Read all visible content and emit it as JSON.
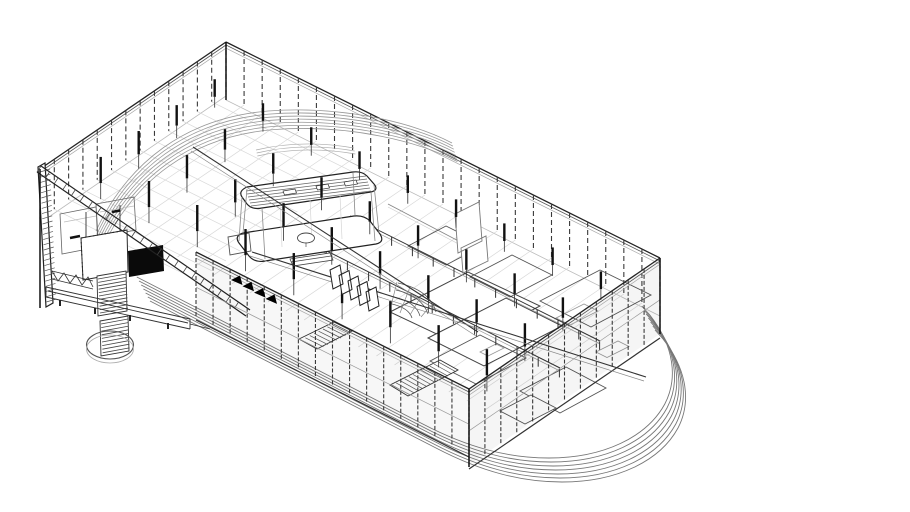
{
  "meta": {
    "title": "Axonometric wireframe cutaway drawing of a rectangular building with a surrounding curved track"
  },
  "palette": {
    "background": "#ffffff",
    "ink": "#111111",
    "dark": "#222222",
    "mid": "#555555",
    "light": "#999999",
    "faint": "#d8d8d8",
    "solid_fill": "#000000"
  },
  "drawing": {
    "corners": {
      "top": [
        226,
        42
      ],
      "right": [
        660,
        258
      ],
      "bottom": [
        469,
        389
      ],
      "left": [
        40,
        169
      ]
    },
    "walls": [
      {
        "a": [
          226,
          42
        ],
        "b": [
          660,
          258
        ],
        "n": 24,
        "drop": 54,
        "dash": "5 3",
        "beam": {
          "dir": [
            -0.826,
            0.563
          ],
          "len": 190
        },
        "front": false
      },
      {
        "a": [
          226,
          42
        ],
        "b": [
          40,
          169
        ],
        "n": 13,
        "drop": 50,
        "dash": "5 3",
        "beam": {
          "dir": [
            0.894,
            0.445
          ],
          "len": 160
        },
        "front": false
      },
      {
        "a": [
          196,
          252
        ],
        "b": [
          469,
          389
        ],
        "n": 16,
        "drop": 64,
        "dash": "4 2",
        "base": true,
        "front": true,
        "tint": "rgba(0,0,0,0.03)"
      },
      {
        "a": [
          469,
          389
        ],
        "b": [
          660,
          258
        ],
        "n": 12,
        "drop": 76,
        "dash": "4 2",
        "base": true,
        "front": true,
        "tint": "rgba(0,0,0,0.04)"
      }
    ],
    "columns": {
      "origin": [
        226,
        42
      ],
      "u": [
        0.894,
        0.445
      ],
      "v": [
        -0.826,
        0.563
      ],
      "a": [
        28,
        82,
        136,
        190,
        244,
        298,
        352,
        406,
        460
      ],
      "b": [
        44,
        90,
        136,
        182
      ],
      "w": 2.4,
      "barFrac": 0.62,
      "color": "#111111"
    },
    "paths": [
      {
        "d": "M150,301 L436,448 C482,472 522,482 562,482 C617,482 660,461 678,428 C691,403 688,371 663,339 L655,330",
        "s": "#777777",
        "w": 0.9,
        "n": 7,
        "dx": -2.2,
        "dy": -4.0
      },
      {
        "d": "M96,231 C128,162 186,118 268,111 C346,105 416,124 452,143",
        "s": "#999999",
        "w": 0.8,
        "n": 7,
        "dx": 0.9,
        "dy": 3.1
      },
      {
        "d": "M256,150 Q302,139 354,148",
        "s": "#aaaaaa",
        "w": 0.7,
        "n": 3,
        "dx": 0.7,
        "dy": 3
      },
      {
        "d": "M388,204 L470,247",
        "s": "#888888",
        "w": 0.9
      },
      {
        "d": "M388,207 L470,250",
        "s": "#cccccc",
        "w": 0.7
      },
      {
        "d": "M390,312 L468,272 L540,306 L462,346 Z",
        "s": "#444444",
        "w": 1,
        "f": "#ffffff"
      },
      {
        "d": "M428,338 L506,298 L562,326 L484,366 Z",
        "s": "#444444",
        "w": 1,
        "f": "#ffffff"
      },
      {
        "d": "M408,246 L446,226 L484,245 L446,265 Z",
        "s": "#555555",
        "w": 0.9
      },
      {
        "d": "M470,277 L512,255 L552,275 L510,297 Z",
        "s": "#555555",
        "w": 0.9
      },
      {
        "d": "M540,301 L600,270 L651,295 L591,327 Z",
        "s": "#555555",
        "w": 0.9
      },
      {
        "d": "M430,361 L480,335 L526,358 L476,384 Z",
        "s": "#555555",
        "w": 0.9
      },
      {
        "d": "M520,391 L566,367 L606,388 L560,413 Z",
        "s": "#555555",
        "w": 0.9
      },
      {
        "d": "M500,411 L531,395 L556,408 L525,424 Z",
        "s": "#555555",
        "w": 0.9,
        "f": "#ffffff"
      },
      {
        "d": "M556,318 l28,-14 l14,7 l-28,14 Z M596,352 l22,-11 l11,5.5 l-22,11 Z M480,352 l16,-8 l8,4 l-16,8 Z",
        "s": "#999999",
        "w": 0.8
      },
      {
        "d": "M305,240 L560,368",
        "s": "#333333",
        "w": 1
      },
      {
        "d": "M305,243 L560,371",
        "s": "#999999",
        "w": 0.7
      },
      {
        "d": "M305,240 l0,9",
        "s": "#333333",
        "w": 1,
        "n": 13,
        "dx": 21.2,
        "dy": 10.7
      },
      {
        "d": "M350,216 L600,341",
        "s": "#333333",
        "w": 1
      },
      {
        "d": "M350,219 L600,344",
        "s": "#999999",
        "w": 0.7
      },
      {
        "d": "M350,216 l0,9",
        "s": "#333333",
        "w": 1,
        "n": 13,
        "dx": 20.8,
        "dy": 10.4
      },
      {
        "d": "M299,339 L334,322 L352,331 L317,349 Z",
        "s": "#333333",
        "w": 0.9,
        "f": "#ffffff"
      },
      {
        "d": "M301,340 L319,349",
        "s": "#555555",
        "w": 0.7,
        "n": 8,
        "dx": 4.4,
        "dy": -2.2
      },
      {
        "d": "M390,385 L440,360 L458,370 L408,396 Z",
        "s": "#333333",
        "w": 0.9,
        "f": "#ffffff"
      },
      {
        "d": "M392,385 L410,395",
        "s": "#555555",
        "w": 0.7,
        "n": 12,
        "dx": 4.2,
        "dy": -2.1
      },
      {
        "d": "M398,283 Q430,290 436,312 M396,290 Q422,296 428,314 M394,297 Q416,302 420,316 M392,304 Q409,308 412,318",
        "s": "#555555",
        "w": 0.8
      },
      {
        "d": "M390,310 L397,282 M400,313 L410,287 M410,315 L423,293 M421,317 L433,303",
        "s": "#888888",
        "w": 0.7
      },
      {
        "d": "M243,233 L354,216 Q364,215 370,221 L380,234 Q385,242 376,244 L265,261 Q255,263 249,256 L239,243 Q234,236 243,233 Z",
        "s": "#222222",
        "w": 1.2,
        "f": "#ffffff"
      },
      {
        "d": "M247,187 L353,172 Q362,171 367,176 L374,184 Q379,190 371,192 L262,208 Q252,210 247,204 L242,197 Q238,191 247,187 Z",
        "s": "#222222",
        "w": 1.2,
        "f": "#ffffff"
      },
      {
        "d": "M246,191 L366,176",
        "s": "#666666",
        "w": 0.7,
        "n": 6,
        "dx": 1.0,
        "dy": 3.0
      },
      {
        "d": "M283,191 l12,-2 l1.5,4 l-12,2 Z M316,186 l12,-2 l1.5,4 l-12,2 Z M344,182 l12,-2 l1.5,4 l-12,2 Z",
        "s": "#333333",
        "w": 0.7,
        "f": "#ffffff"
      },
      {
        "d": "M247,189 L243,233 M242,197 L239,241 M371,192 L375,241 M374,185 L379,233 M262,208 L265,259 M353,173 L355,215",
        "s": "#888888",
        "w": 0.8
      },
      {
        "d": "M280,204 L282,247 M310,199 L312,243 M340,195 L342,239",
        "s": "#d5d5d5",
        "w": 0.7
      },
      {
        "d": "M297.5,238 a8.5,5 0 1 0 17,0 a8.5,5 0 1 0 -17,0",
        "s": "#444444",
        "w": 0.9,
        "f": "#ffffff"
      },
      {
        "d": "M306,243 L306,247",
        "s": "#666666",
        "w": 0.8
      },
      {
        "d": "M290,259 L330,253 L333,260 L293,266 Z M291,262 L331,256",
        "s": "#444444",
        "w": 0.8,
        "f": "#ffffff"
      },
      {
        "d": "M228,237 L249,233 L251,251 L230,255 Z",
        "s": "#555555",
        "w": 0.9
      },
      {
        "d": "M455,214 L479,202 L482,241 L458,253 Z M461,248 L486,236 L488,261 L463,273 Z",
        "s": "#777777",
        "w": 0.9,
        "f": "#ffffff"
      },
      {
        "d": "M38,167 L45,163 L53,303 L46,307 Z",
        "s": "#222222",
        "w": 1.2,
        "f": "#ffffff"
      },
      {
        "d": "M40,172 L50,169",
        "s": "#555555",
        "w": 0.7,
        "n": 26,
        "dx": 0.25,
        "dy": 5.2
      },
      {
        "d": "M60,214 L96,207 L98,247 L62,254 Z M96,204 L134,197 L136,230 L98,237 Z",
        "s": "#666666",
        "w": 0.8
      },
      {
        "d": "M64,222 L96,216 M100,212 L134,206",
        "s": "#bbbbbb",
        "w": 0.7
      },
      {
        "d": "M86,212 L86,244 M120,205 L120,236",
        "s": "#444444",
        "w": 1
      },
      {
        "d": "M70,238 l10,-2 M112,212 l8,-1.5",
        "s": "#111111",
        "w": 2.5
      },
      {
        "d": "M81,238 L127,230 L128,272 L83,280 Z",
        "s": "#2a2a2a",
        "w": 1,
        "f": "#ffffff"
      },
      {
        "d": "M81,238 L127,230 M81,238 L83,280",
        "s": "#222222",
        "w": 1,
        "da": "1.5 2.5"
      },
      {
        "d": "M128,251 L163,245 L164,271 L129,277 Z",
        "f": "#0a0a0a"
      },
      {
        "d": "M97,276 L126,271 L127,311 L98,316 Z",
        "s": "#333333",
        "w": 0.9,
        "f": "#ffffff"
      },
      {
        "d": "M98,279 L126,274",
        "s": "#444444",
        "w": 0.8,
        "n": 11,
        "dx": 0.2,
        "dy": 3.4
      },
      {
        "d": "M100,321 L128,316 L129,351 L101,356 Z",
        "s": "#333333",
        "w": 0.9,
        "f": "#ffffff"
      },
      {
        "d": "M101,324 L128,319",
        "s": "#444444",
        "w": 0.8,
        "n": 9,
        "dx": 0.2,
        "dy": 3.6
      },
      {
        "d": "M52,271 L93,281 M52,279 L93,289 M52,271 L58,281 L64,273 L70,283 L76,275 L82,285 L88,277 L93,287",
        "s": "#333333",
        "w": 0.8
      },
      {
        "d": "M46,287 L190,319 M46,297 L190,329 M46,287 L46,297 M190,319 L190,329 M48,291 L188,323 M190,324 L210,329",
        "s": "#333333",
        "w": 0.9,
        "f": "none"
      },
      {
        "d": "M60,300 l0,6 M95,308 l0,6 M130,315 l0,6 M168,323 l0,6",
        "s": "#222222",
        "w": 2
      },
      {
        "d": "M86.5,345 a23.5,14 0 1 0 47,0 a23.5,14 0 1 0 -47,0",
        "s": "#555555",
        "w": 1.1
      },
      {
        "d": "M86.5,349 a23.5,14 0 1 0 47,0 a23.5,14 0 1 0 -47,0",
        "s": "#aaaaaa",
        "w": 0.8
      },
      {
        "d": "M41,166 L250,310 M37,172 L246,316",
        "s": "#222222",
        "w": 1.2
      },
      {
        "d": "M41,166 L37,172",
        "s": "#444444",
        "w": 0.8,
        "n": 24,
        "dx": 8.6,
        "dy": 5.9
      },
      {
        "d": "M193,147 L478,332",
        "s": "#333333",
        "w": 1.1,
        "front": true
      },
      {
        "d": "M191,151 L476,336",
        "s": "#888888",
        "w": 0.7,
        "front": true
      },
      {
        "d": "M252,252 L646,377",
        "s": "#333333",
        "w": 1.1,
        "front": true
      },
      {
        "d": "M250,256 L644,381",
        "s": "#888888",
        "w": 0.7,
        "front": true
      },
      {
        "d": "M330,270 l10,-5 l3,19 l-10,5 Z M339,275.5 l10,-5 l3,19 l-10,5 Z M348,281 l10,-5 l3,19 l-10,5 Z M357,286.5 l10,-5 l3,19 l-10,5 Z M366,292 l10,-5 l3,19 l-10,5 Z",
        "s": "#222222",
        "w": 1,
        "f": "#ffffff",
        "front": true
      },
      {
        "d": "M231,280 l9,-4.5 l2.5,9.5 Z M242.5,286.3 l9,-4.5 l2.5,9.5 Z M254,292.6 l9,-4.5 l2.5,9.5 Z M265.5,298.9 l9,-4.5 l2.5,9.5 Z",
        "f": "#000000",
        "front": true
      },
      {
        "d": "M226,42 L226,100 M660,258 L660,334 M40,169 L40,308 M469,389 L469,467",
        "s": "#111111",
        "w": 1.5,
        "front": true
      }
    ]
  }
}
